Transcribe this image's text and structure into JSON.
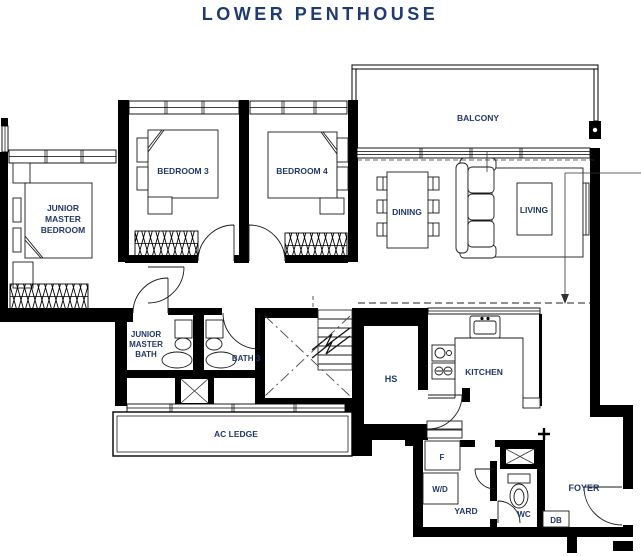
{
  "title": "LOWER PENTHOUSE",
  "colors": {
    "title": "#203a72",
    "label": "#22386a",
    "wall": "#000000"
  },
  "rooms": {
    "junior_master_bedroom": {
      "lines": [
        "JUNIOR",
        "MASTER",
        "BEDROOM"
      ]
    },
    "bedroom3": {
      "label": "BEDROOM 3"
    },
    "bedroom4": {
      "label": "BEDROOM 4"
    },
    "balcony": {
      "label": "BALCONY"
    },
    "dining": {
      "label": "DINING"
    },
    "living": {
      "label": "LIVING"
    },
    "junior_master_bath": {
      "lines": [
        "JUNIOR",
        "MASTER",
        "BATH"
      ]
    },
    "bath3": {
      "label": "BATH 3"
    },
    "household_shelter": {
      "label": "HS"
    },
    "kitchen": {
      "label": "KITCHEN"
    },
    "ac_ledge": {
      "label": "AC LEDGE"
    },
    "fridge": {
      "label": "F"
    },
    "washer_dryer": {
      "label": "W/D"
    },
    "yard": {
      "label": "YARD"
    },
    "wc": {
      "label": "WC"
    },
    "db": {
      "label": "DB"
    },
    "foyer": {
      "label": "FOYER"
    }
  }
}
